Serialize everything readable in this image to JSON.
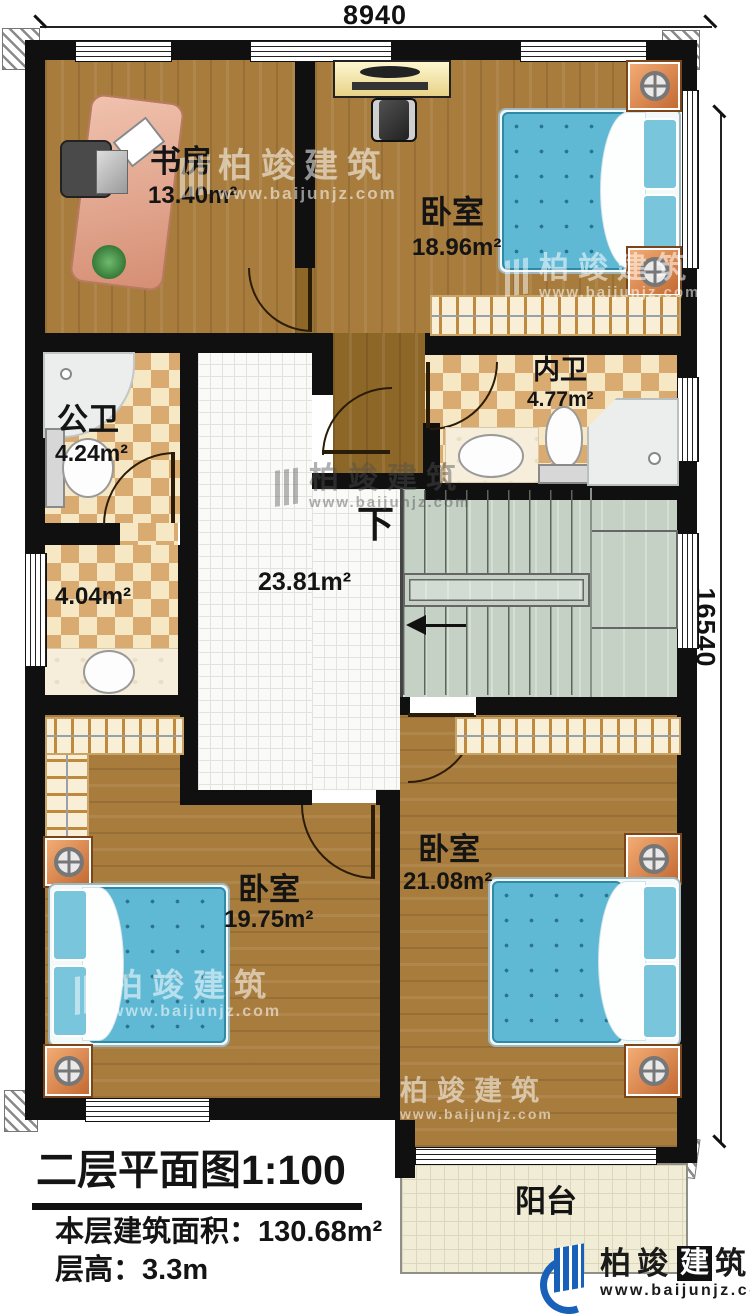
{
  "dimensions": {
    "width_mm": "8940",
    "height_mm": "16540"
  },
  "rooms": {
    "study": {
      "name": "书房",
      "area": "13.40m²"
    },
    "bedroom_top": {
      "name": "卧室",
      "area": "18.96m²"
    },
    "ensuite_bath": {
      "name": "内卫",
      "area": "4.77m²"
    },
    "shared_bath": {
      "name": "公卫",
      "area": "4.24m²"
    },
    "dressing": {
      "area": "4.04m²"
    },
    "hall": {
      "area": "23.81m²",
      "stairs_down": "下"
    },
    "bedroom_left": {
      "name": "卧室",
      "area": "19.75m²"
    },
    "bedroom_right": {
      "name": "卧室",
      "area": "21.08m²"
    },
    "balcony": {
      "name": "阳台"
    }
  },
  "title_block": {
    "title": "二层平面图",
    "scale": "1:100",
    "floor_area_label": "本层建筑面积：",
    "floor_area_value": "130.68m²",
    "floor_height_label": "层高：",
    "floor_height_value": "3.3m"
  },
  "watermark": {
    "brand": "柏竣建筑",
    "url": "www.baijunjz.com"
  },
  "logo": {
    "brand_a": "柏竣",
    "brand_b": "建",
    "brand_c": "筑",
    "url": "www.baijunjz.com"
  },
  "colors": {
    "wall": "#101010",
    "wood": "#a87c3c",
    "checker_tan": "#d9ab70",
    "stair_sage": "#c5d1c5",
    "bed_blue": "#5fb8d4",
    "nightstand_orange": "#e08b4e",
    "logo_blue": "#1960b8"
  }
}
